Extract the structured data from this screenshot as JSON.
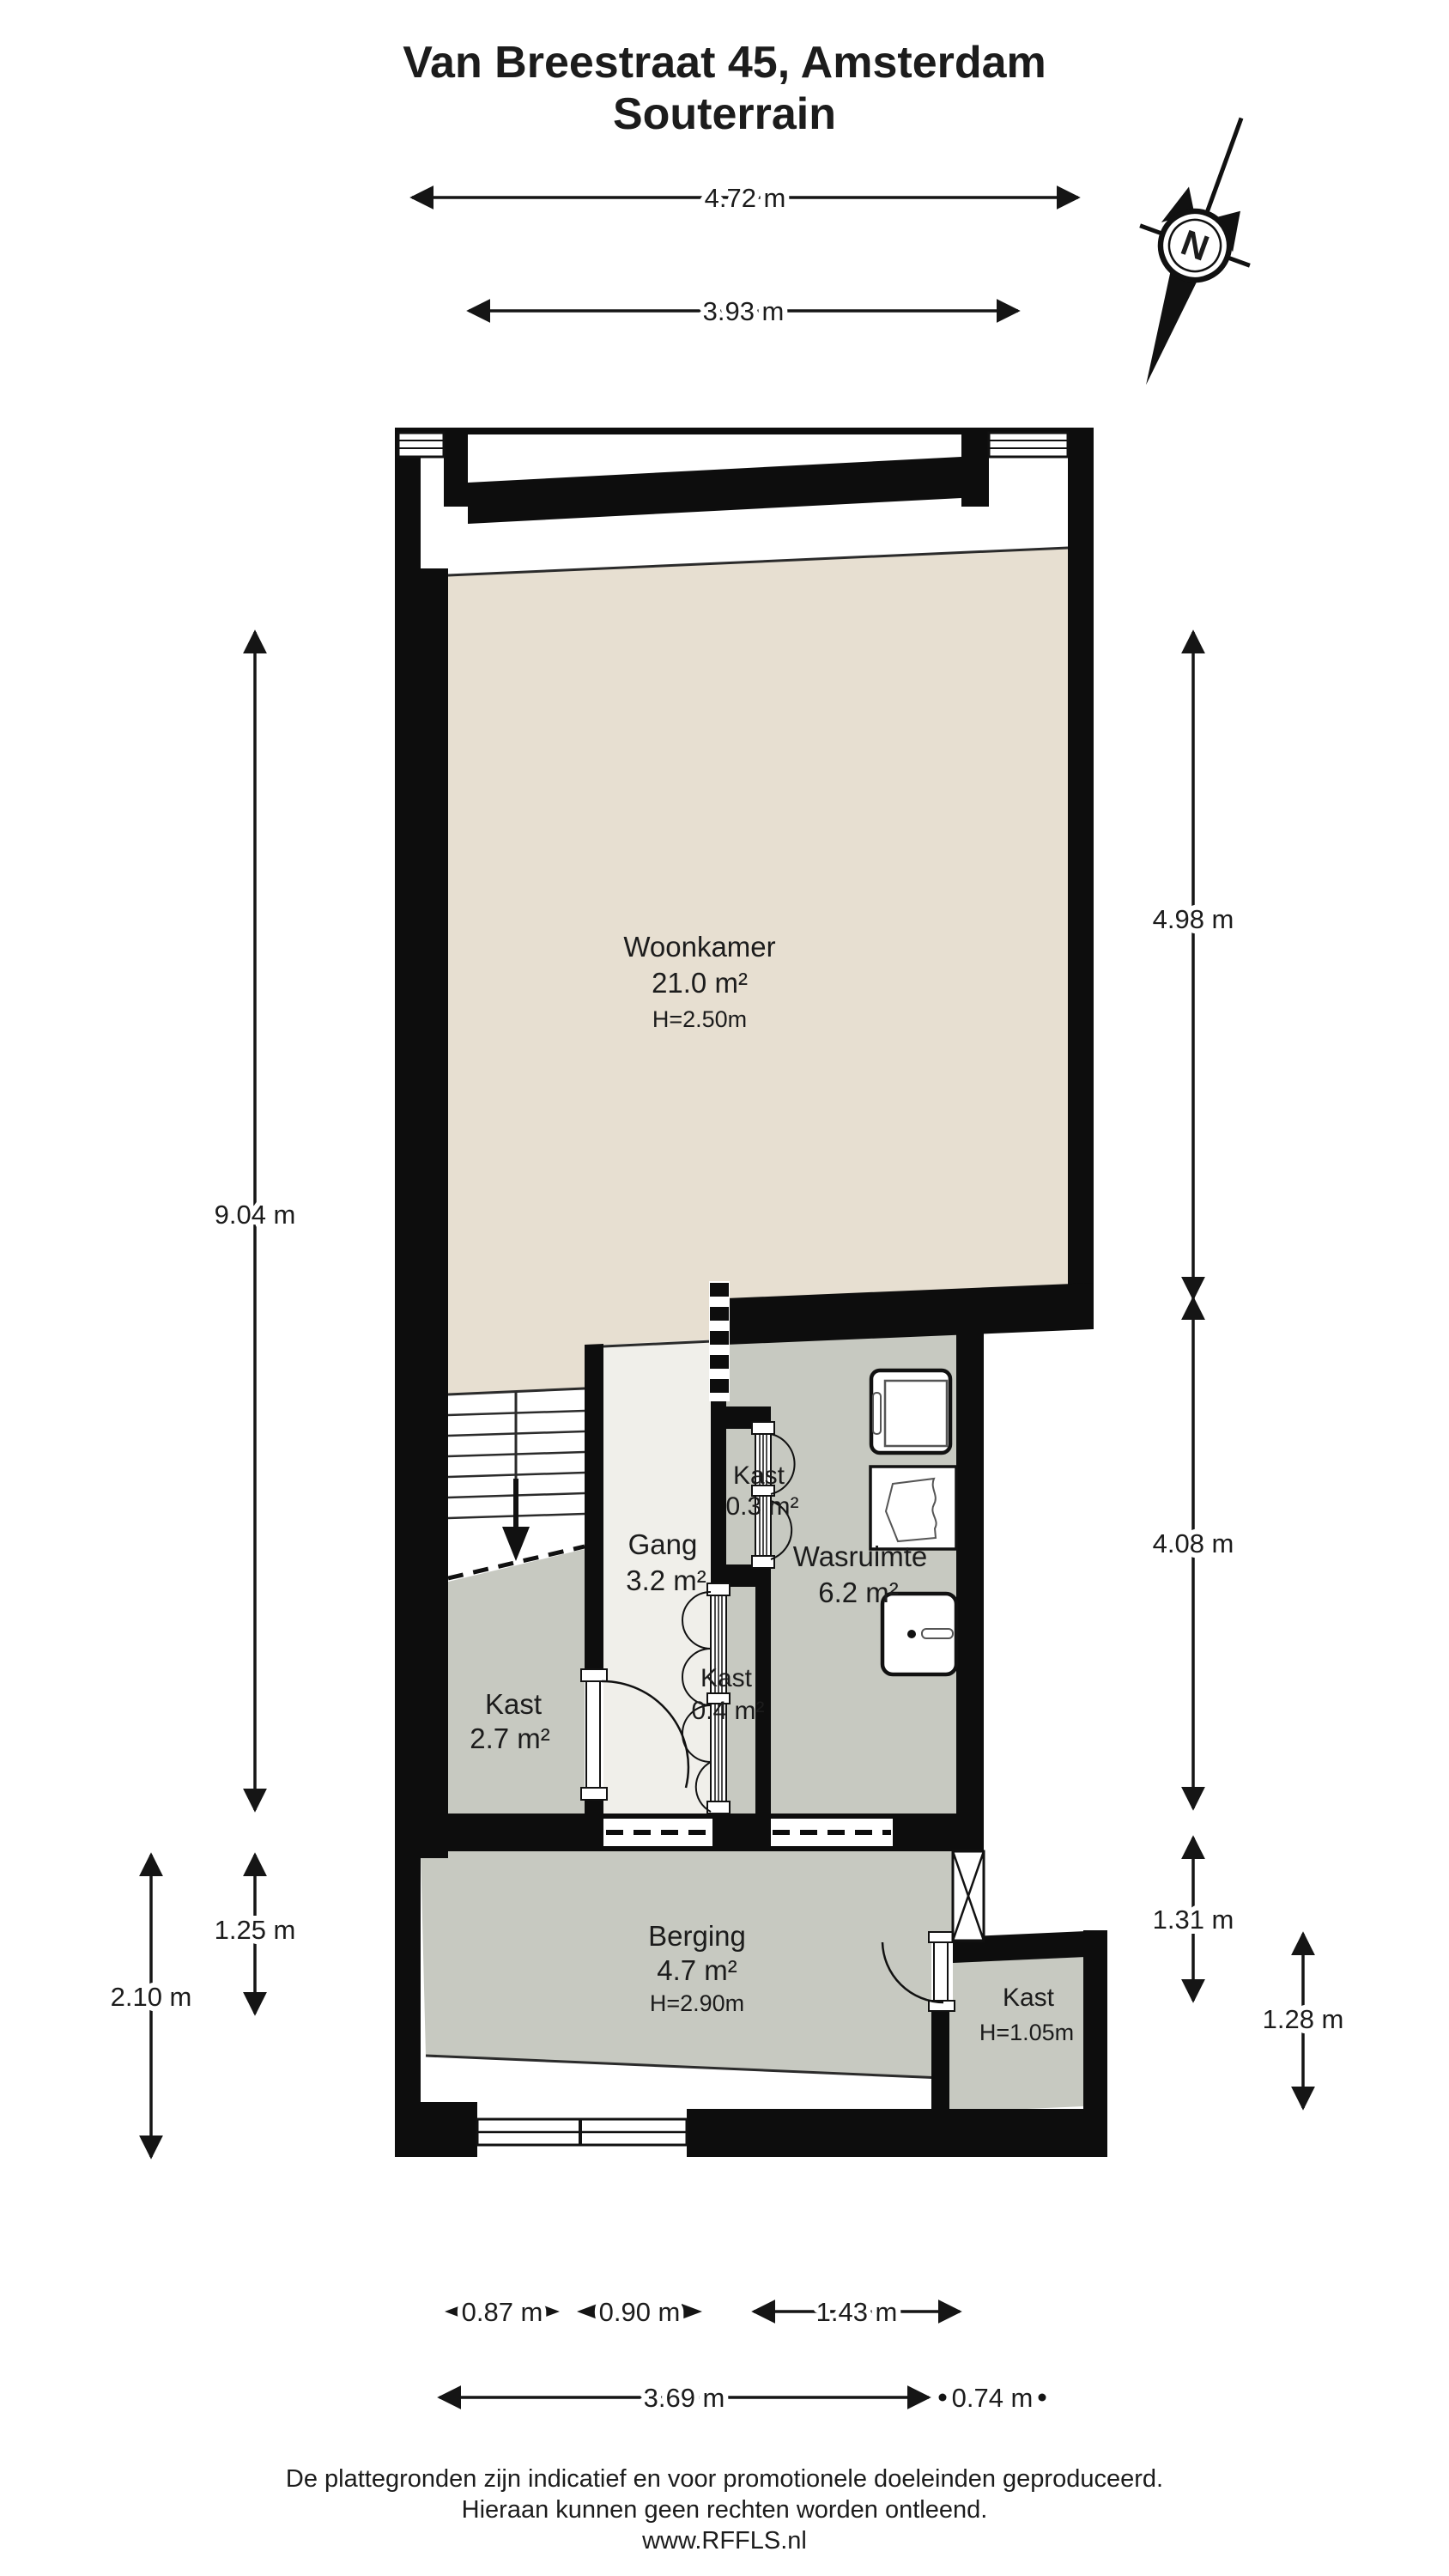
{
  "title": {
    "line1": "Van Breestraat 45, Amsterdam",
    "line2": "Souterrain"
  },
  "compass": {
    "label": "N"
  },
  "rooms": {
    "woonkamer": {
      "name": "Woonkamer",
      "area": "21.0 m²",
      "ceiling": "H=2.50m"
    },
    "gang": {
      "name": "Gang",
      "area": "3.2 m²"
    },
    "kast_klein": {
      "name": "Kast",
      "area": "0.3 m²"
    },
    "wasruimte": {
      "name": "Wasruimte",
      "area": "6.2 m²"
    },
    "kast_gang": {
      "name": "Kast",
      "area": "0.4 m²"
    },
    "kast_trap": {
      "name": "Kast",
      "area": "2.7 m²"
    },
    "berging": {
      "name": "Berging",
      "area": "4.7 m²",
      "ceiling": "H=2.90m"
    },
    "kast_berging": {
      "name": "Kast",
      "ceiling": "H=1.05m"
    }
  },
  "dimensions": {
    "top": [
      "4.72 m",
      "3.93 m"
    ],
    "left": [
      "9.04 m",
      "1.25 m",
      "2.10 m"
    ],
    "right": [
      "4.98 m",
      "4.08 m",
      "1.31 m",
      "1.28 m"
    ],
    "bottom_inner": [
      "0.87 m",
      "0.90 m",
      "1.43 m"
    ],
    "bottom_outer": [
      "3.69 m",
      "0.74 m"
    ]
  },
  "footer": {
    "line1": "De plattegronden zijn indicatief en voor promotionele doeleinden geproduceerd.",
    "line2": "Hieraan kunnen geen rechten worden ontleend.",
    "line3": "www.RFFLS.nl"
  },
  "colors": {
    "floor_beige": "#e7dfd1",
    "floor_gray": "#c7c9c1",
    "floor_light": "#f0efea",
    "wall": "#0d0d0d",
    "text": "#1c1c1c"
  }
}
